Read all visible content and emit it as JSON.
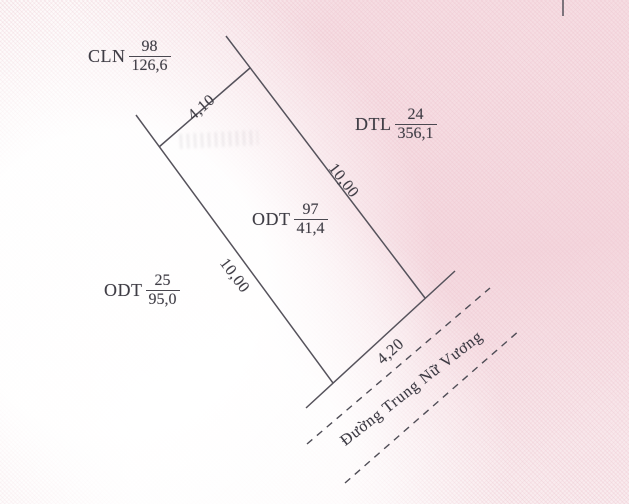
{
  "map": {
    "title": "Cadastral parcel sketch",
    "parcels": [
      {
        "id": "parcel-cln-98",
        "code": "CLN",
        "number": "98",
        "area": "126,6"
      },
      {
        "id": "parcel-dtl-24",
        "code": "DTL",
        "number": "24",
        "area": "356,1"
      },
      {
        "id": "parcel-odt-97",
        "code": "ODT",
        "number": "97",
        "area": "41,4"
      },
      {
        "id": "parcel-odt-25",
        "code": "ODT",
        "number": "25",
        "area": "95,0"
      }
    ],
    "edge_dimensions": [
      {
        "side": "top",
        "value": "4,10"
      },
      {
        "side": "right",
        "value": "10,00"
      },
      {
        "side": "left",
        "value": "10,00"
      },
      {
        "side": "bottom",
        "value": "4,20"
      }
    ],
    "street_name": "Đường Trung Nữ Vương",
    "colors": {
      "boundary_line": "#55525b",
      "road_dash_line": "#4f4d56",
      "text": "#3f3d45",
      "paper_pink": "#f3dce1",
      "paper_base": "#fcf8f8"
    }
  }
}
